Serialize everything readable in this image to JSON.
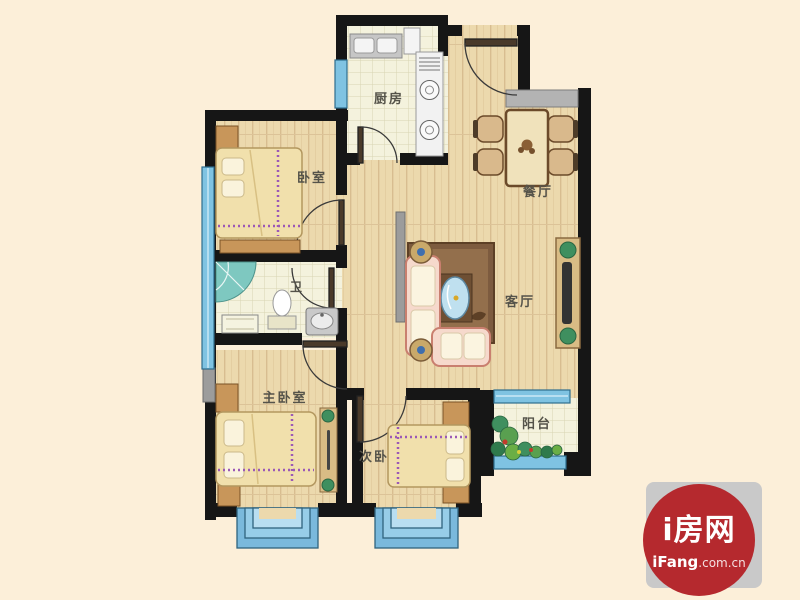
{
  "page": {
    "background_color": "#fcefd9"
  },
  "floorplan": {
    "rooms": [
      {
        "id": "bedroom",
        "label": "卧室"
      },
      {
        "id": "kitchen",
        "label": "厨房"
      },
      {
        "id": "dining-room",
        "label": "餐厅"
      },
      {
        "id": "bathroom",
        "label": "卫"
      },
      {
        "id": "living-room",
        "label": "客厅"
      },
      {
        "id": "master-bedroom",
        "label": "主卧室"
      },
      {
        "id": "second-bedroom",
        "label": "次卧"
      },
      {
        "id": "balcony",
        "label": "阳台"
      }
    ],
    "colors": {
      "wall": "#161616",
      "window_blue": "#7fc3e2",
      "wood_floor": "#ecd9ad",
      "tile_floor": "#f4f2dd",
      "counter_gray": "#b3b3b3"
    }
  },
  "watermark": {
    "brand": "i房网",
    "domain": "iFang",
    "domain_suffix": ".com.cn",
    "circle_color": "#b5292e",
    "square_color": "#c9c9c9"
  }
}
